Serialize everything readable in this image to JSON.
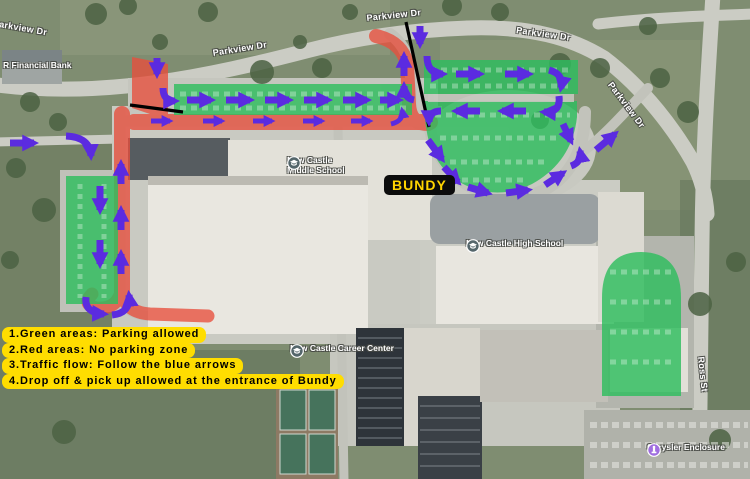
{
  "streets": [
    {
      "name": "Parkview Dr"
    },
    {
      "name": "Parkview Dr"
    },
    {
      "name": "Parkview Dr"
    },
    {
      "name": "Parkview Dr"
    },
    {
      "name": "Parkview Dr"
    },
    {
      "name": "Ross St"
    }
  ],
  "places": [
    {
      "name": "R Financial Bank"
    },
    {
      "name": "New Castle Middle School",
      "line1": "New Castle",
      "line2": "Middle School"
    },
    {
      "name": "New Castle High School"
    },
    {
      "name": "New Castle Career Center"
    },
    {
      "name": "Chrysler Enclosure"
    }
  ],
  "bundy": {
    "label": "BUNDY"
  },
  "legend": {
    "items": [
      "1.Green areas: Parking allowed",
      "2.Red areas: No parking zone",
      "3.Traffic flow: Follow the blue arrows",
      "4.Drop off & pick up allowed at the entrance of Bundy"
    ]
  },
  "colors": {
    "green_zone": "#2ebd5e",
    "red_zone": "#e84f3d",
    "arrow_purple": "#5b2be0",
    "label_yellow": "#ffdd00",
    "bundy_bg": "#0c0c0c",
    "bundy_text": "#ffd400"
  }
}
